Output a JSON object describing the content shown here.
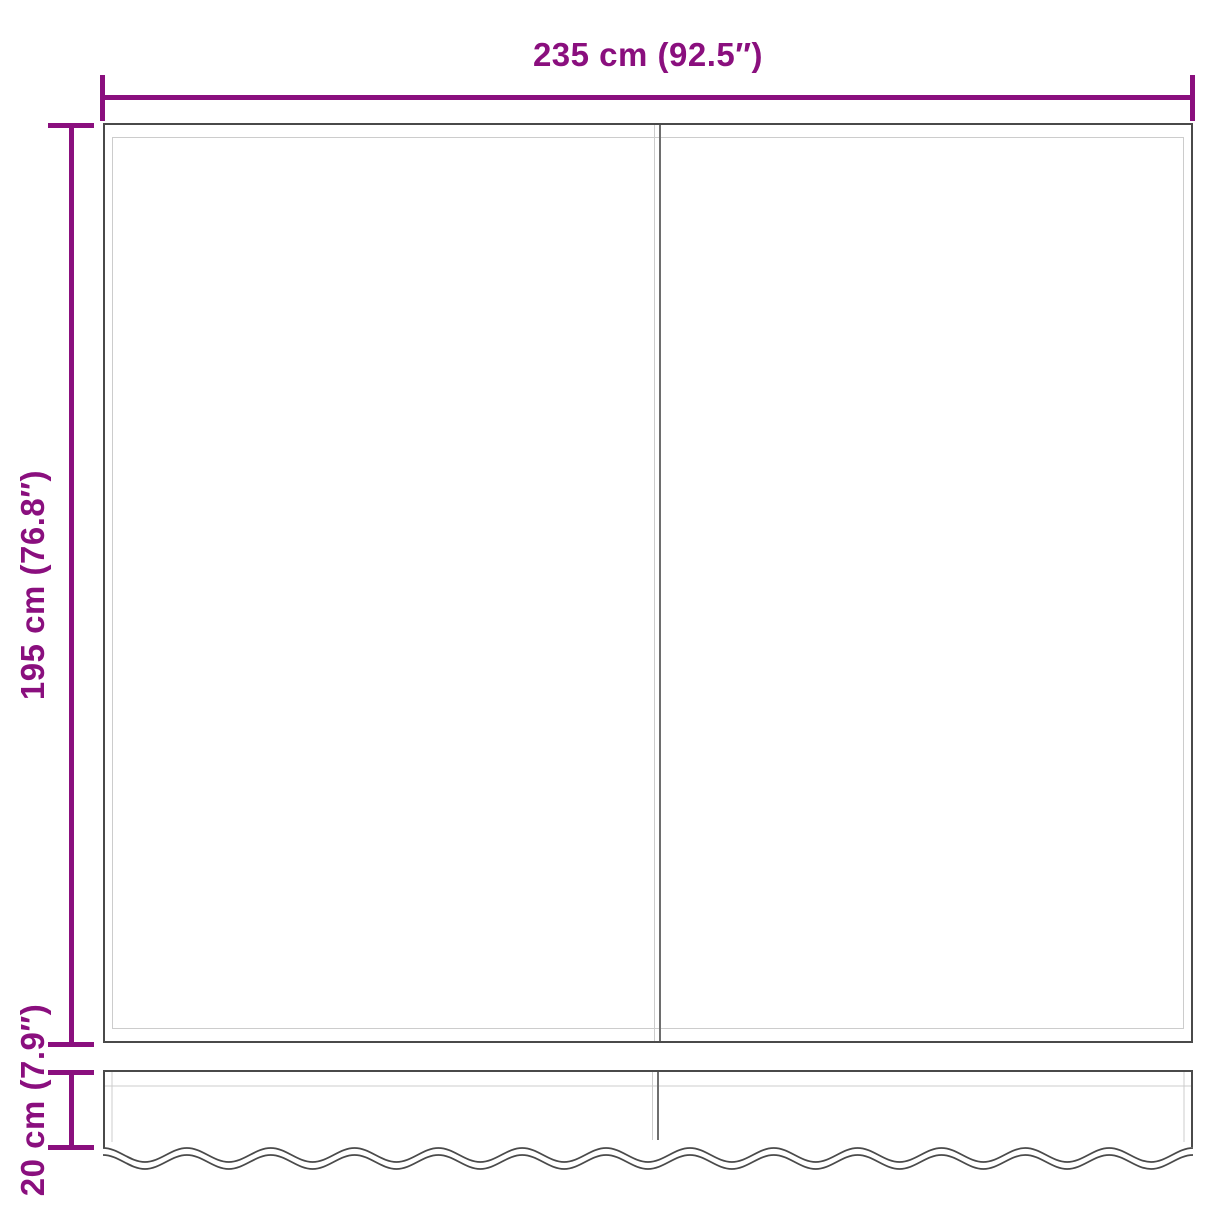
{
  "diagram": {
    "title": "awning-fabric-dimension-diagram",
    "width_label": "235 cm (92.5″)",
    "height_label": "195 cm (76.8″)",
    "valance_label": "20 cm (7.9″)",
    "colors": {
      "dimension": "#8a0f7e",
      "outline": "#4a4a4a",
      "seam": "#6e6e6e",
      "inner_line": "#cccccc",
      "background": "#ffffff"
    }
  }
}
